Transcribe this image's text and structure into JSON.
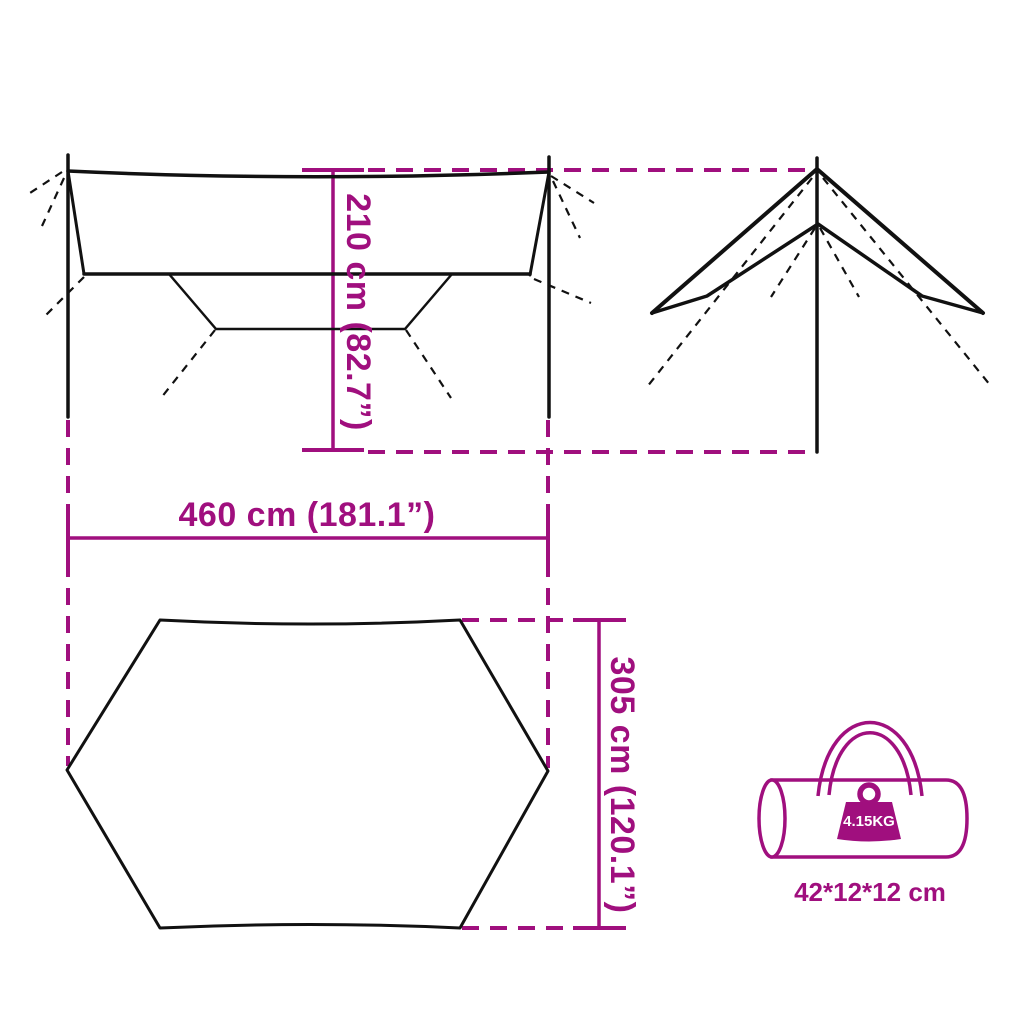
{
  "colors": {
    "accent": "#A00F7E",
    "line": "#111111",
    "background": "#FFFFFF",
    "label_on_accent": "#FFFFFF"
  },
  "diagram": {
    "title": "Tarp dimensions diagram",
    "dimensions": {
      "height_label": "210 cm (82.7”)",
      "width_label": "460 cm (181.1”)",
      "depth_label": "305 cm (120.1”)"
    },
    "bag": {
      "weight_label": "4.15KG",
      "size_label": "42*12*12 cm"
    }
  }
}
